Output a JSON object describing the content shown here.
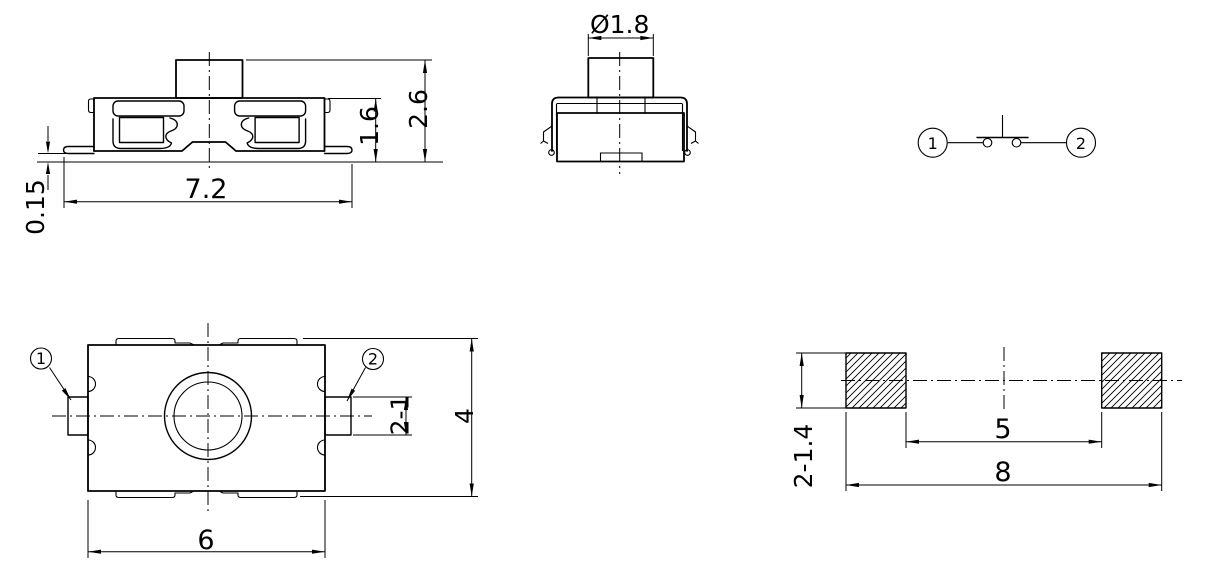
{
  "page": {
    "colors": {
      "background": "#ffffff",
      "line": "#000000"
    }
  },
  "views": {
    "front": {
      "dim_overall_width": "7.2",
      "dim_body_height": "1.6",
      "dim_total_height": "2.6",
      "dim_standoff": "0.15"
    },
    "side": {
      "dim_button_diameter": "Ø1.8"
    },
    "schematic": {
      "terminal_1": "1",
      "terminal_2": "2"
    },
    "top": {
      "label_terminal_1": "1",
      "label_terminal_2": "2",
      "dim_body_width": "6",
      "dim_body_height": "4",
      "dim_terminal_width": "2-1"
    },
    "footprint": {
      "dim_pad_inner_span": "5",
      "dim_overall_span": "8",
      "dim_pad_size": "2-1.4"
    }
  }
}
